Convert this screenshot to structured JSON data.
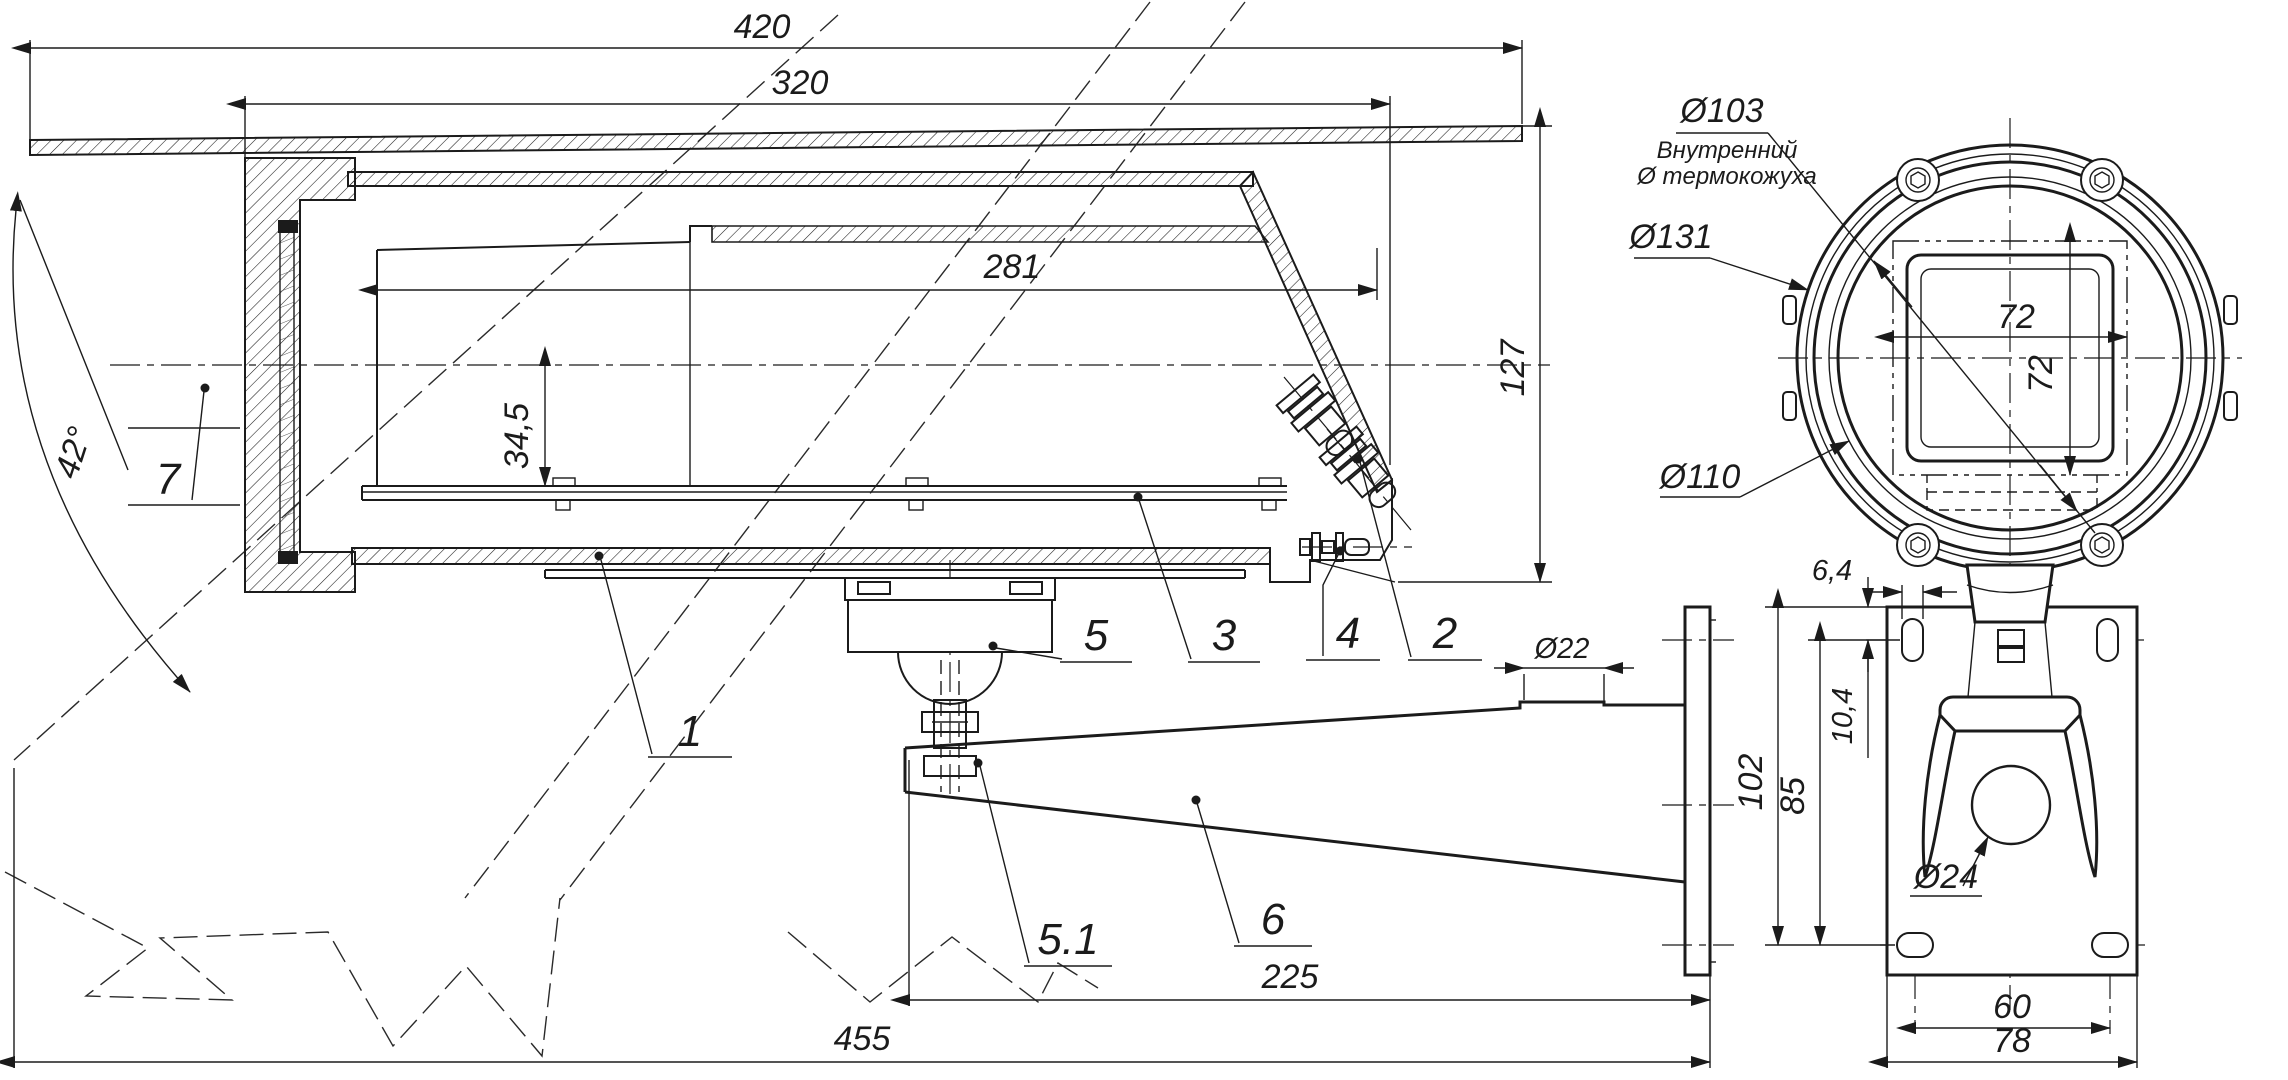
{
  "dims": {
    "d420": "420",
    "d320": "320",
    "d281": "281",
    "d34_5": "34,5",
    "a42": "42°",
    "d127": "127",
    "d22": "Ø22",
    "d225": "225",
    "d455": "455",
    "d103": "Ø103",
    "d131": "Ø131",
    "d110": "Ø110",
    "d72w": "72",
    "d72h": "72",
    "d6_4": "6,4",
    "d10_4": "10,4",
    "d85": "85",
    "d102": "102",
    "d24": "Ø24",
    "d60": "60",
    "d78": "78"
  },
  "notes": {
    "inner_line1": "Внутренний",
    "inner_line2": "Ø термокожуха"
  },
  "part_labels": {
    "p1": "1",
    "p2": "2",
    "p3": "3",
    "p4": "4",
    "p5": "5",
    "p5_1": "5.1",
    "p6": "6",
    "p7": "7"
  }
}
